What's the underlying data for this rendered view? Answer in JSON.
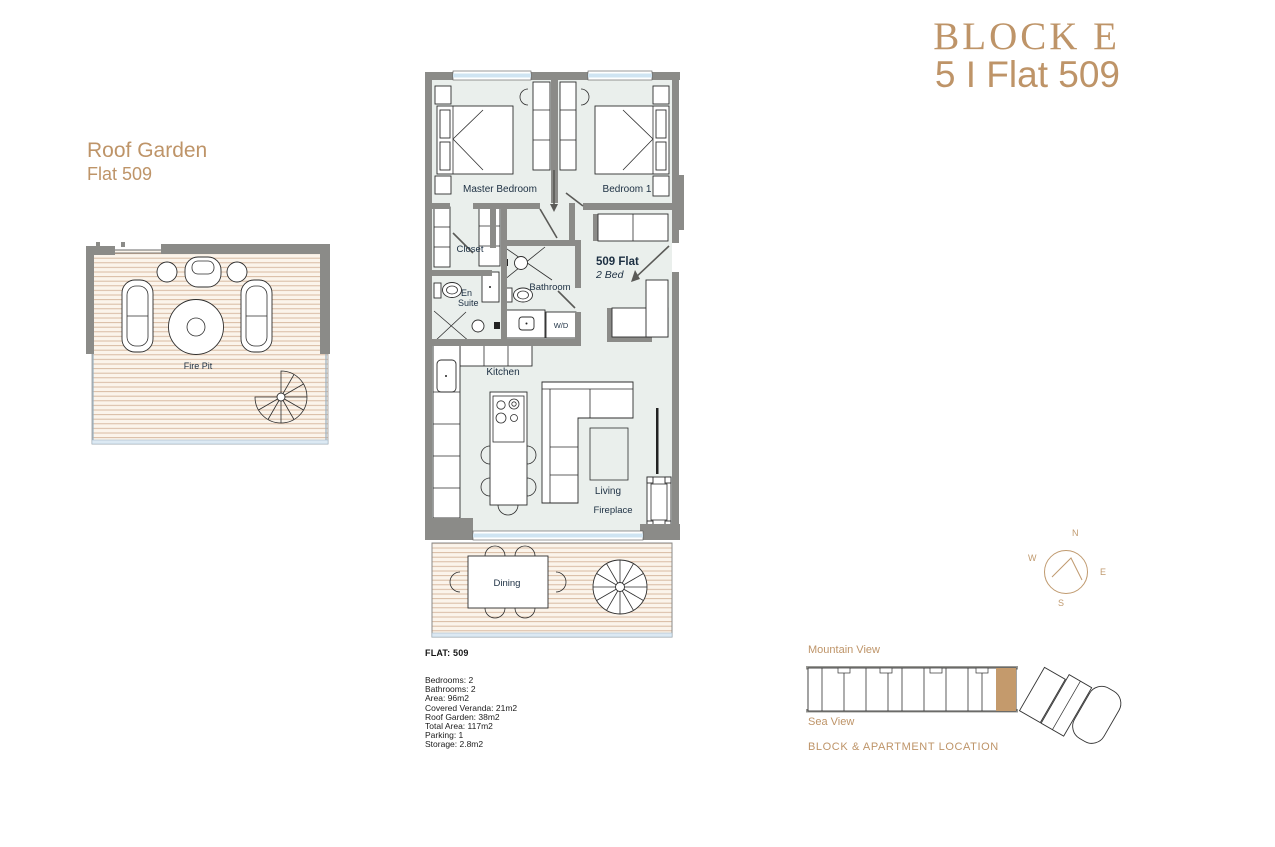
{
  "header": {
    "block": "BLOCK E",
    "flat": "5 I Flat 509"
  },
  "roof_garden": {
    "title": "Roof Garden",
    "subtitle": "Flat 509",
    "fire_pit": "Fire Pit"
  },
  "plan": {
    "labels": {
      "master_bedroom": "Master Bedroom",
      "bedroom_1": "Bedroom 1",
      "closet": "Closet",
      "en_suite_l1": "En",
      "en_suite_l2": "Suite",
      "bathroom": "Bathroom",
      "wd": "W/D",
      "flat_name": "509 Flat",
      "flat_type": "2 Bed",
      "kitchen": "Kitchen",
      "living": "Living",
      "fireplace": "Fireplace",
      "dining": "Dining"
    }
  },
  "details": {
    "heading": "FLAT: 509",
    "items": [
      "Bedrooms: 2",
      "Bathrooms: 2",
      "Area: 96m2",
      "Covered Veranda: 21m2",
      "Roof Garden: 38m2",
      "Total Area: 117m2",
      "Parking: 1",
      "Storage: 2.8m2"
    ]
  },
  "compass": {
    "n": "N",
    "e": "E",
    "s": "S",
    "w": "W"
  },
  "location": {
    "mountain_view": "Mountain View",
    "sea_view": "Sea View",
    "caption": "BLOCK & APARTMENT LOCATION"
  },
  "colors": {
    "accent": "#BE9468",
    "highlight": "#C49A6C",
    "wall": "#8B8B88",
    "floor": "#EAEFEC",
    "glass": "#CFE4F2",
    "deck_line": "#D4B49A",
    "label": "#1C2F42"
  }
}
